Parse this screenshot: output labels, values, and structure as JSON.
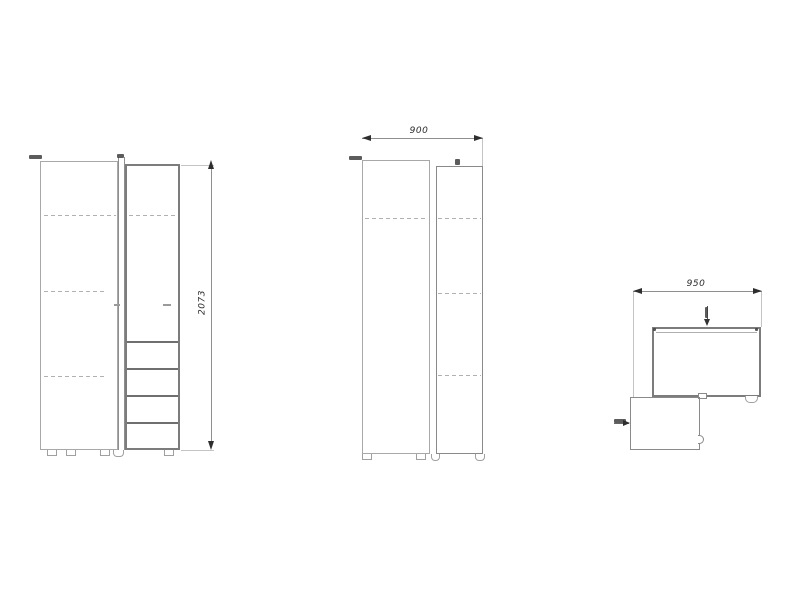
{
  "drawing": {
    "background": "#ffffff",
    "colors": {
      "line_light": "#c4c4c4",
      "line_mid": "#8f8f8f",
      "line_dark": "#6f6f6f",
      "dimension_text": "#2a2a2a"
    },
    "views": {
      "front": {
        "height_dim": "2073"
      },
      "side": {
        "width_dim": "900"
      },
      "plan": {
        "width_dim": "950"
      }
    }
  }
}
